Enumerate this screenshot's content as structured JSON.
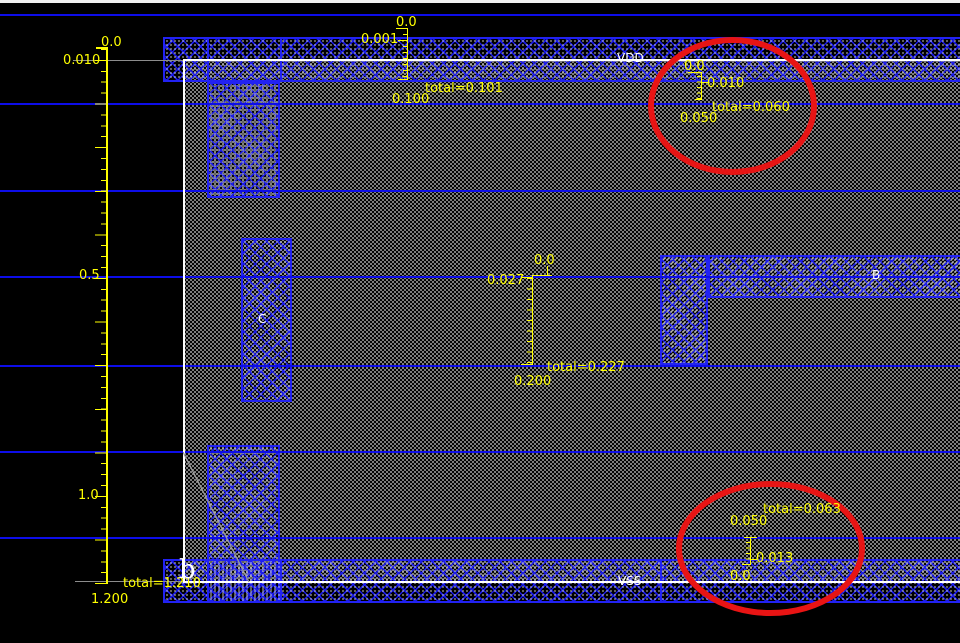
{
  "app": {
    "type": "ic-layout-editor-canvas"
  },
  "colors": {
    "background": "#000000",
    "shape_blue": "#2222f2",
    "grid_blue": "#0d0de8",
    "ruler_yellow": "#ffff00",
    "boundary_white": "#ffffff",
    "measure_gray": "#8c8c8c",
    "highlight_red": "#e81414"
  },
  "nets": {
    "vdd": "VDD",
    "vss": "VSS"
  },
  "pins": {
    "b": "B",
    "c": "C"
  },
  "cell": {
    "marker": "b"
  },
  "rulers": {
    "left": {
      "start": "0.0",
      "first": "0.010",
      "half": "0.5",
      "one": "1.0",
      "total": "total=1.210",
      "end": "1.200"
    },
    "top": {
      "start": "0.0",
      "first": "0.001",
      "total": "total=0.101",
      "end": "0.100"
    },
    "middle": {
      "start": "0.0",
      "first": "0.027",
      "total": "total=0.227",
      "end": "0.200"
    },
    "top_right": {
      "start": "0.0",
      "first": "0.010",
      "total": "total=0.060",
      "end": "0.050"
    },
    "bottom_right": {
      "start": "0.0",
      "first": "0.013",
      "total": "total=0.063",
      "end": "0.050"
    }
  }
}
